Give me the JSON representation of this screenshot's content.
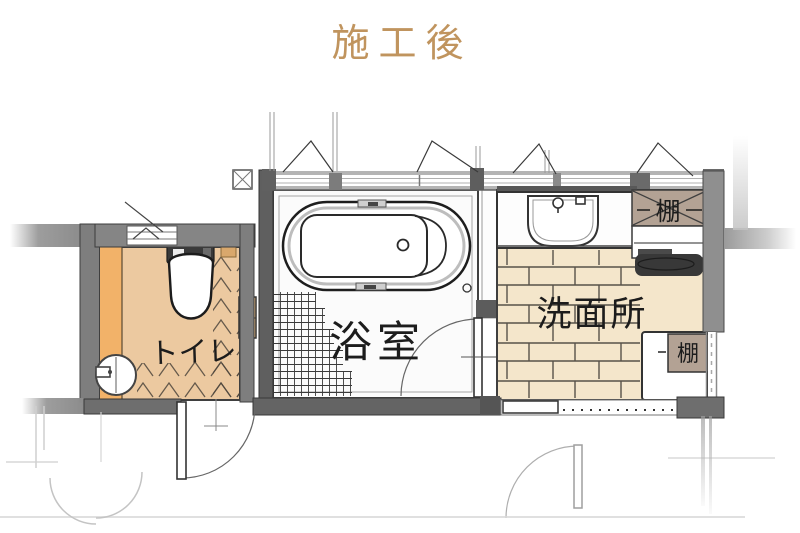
{
  "title": {
    "text": "施工後"
  },
  "plan": {
    "rooms": [
      {
        "id": "toilet",
        "label": "トイレ"
      },
      {
        "id": "bath",
        "label": "浴室"
      },
      {
        "id": "washroom",
        "label": "洗面所"
      }
    ],
    "shelves": [
      {
        "id": "shelf-upper",
        "label": "棚"
      },
      {
        "id": "shelf-lower",
        "label": "棚"
      }
    ]
  },
  "colors": {
    "gold": "#c0945e",
    "ink": "#1c1c1c",
    "wallDark": "#5f5f5f",
    "wallMid": "#7e7e7e",
    "wallLight": "#b4b4b4",
    "floorToilet": "#ecc9a0",
    "floorToiletStrip": "#f2b269",
    "floorBath": "#fbfbfb",
    "floorWash": "#f4e6cb",
    "shelf": "#b3a294",
    "appliance": "#383838",
    "woodAccent": "#d9a86c"
  }
}
